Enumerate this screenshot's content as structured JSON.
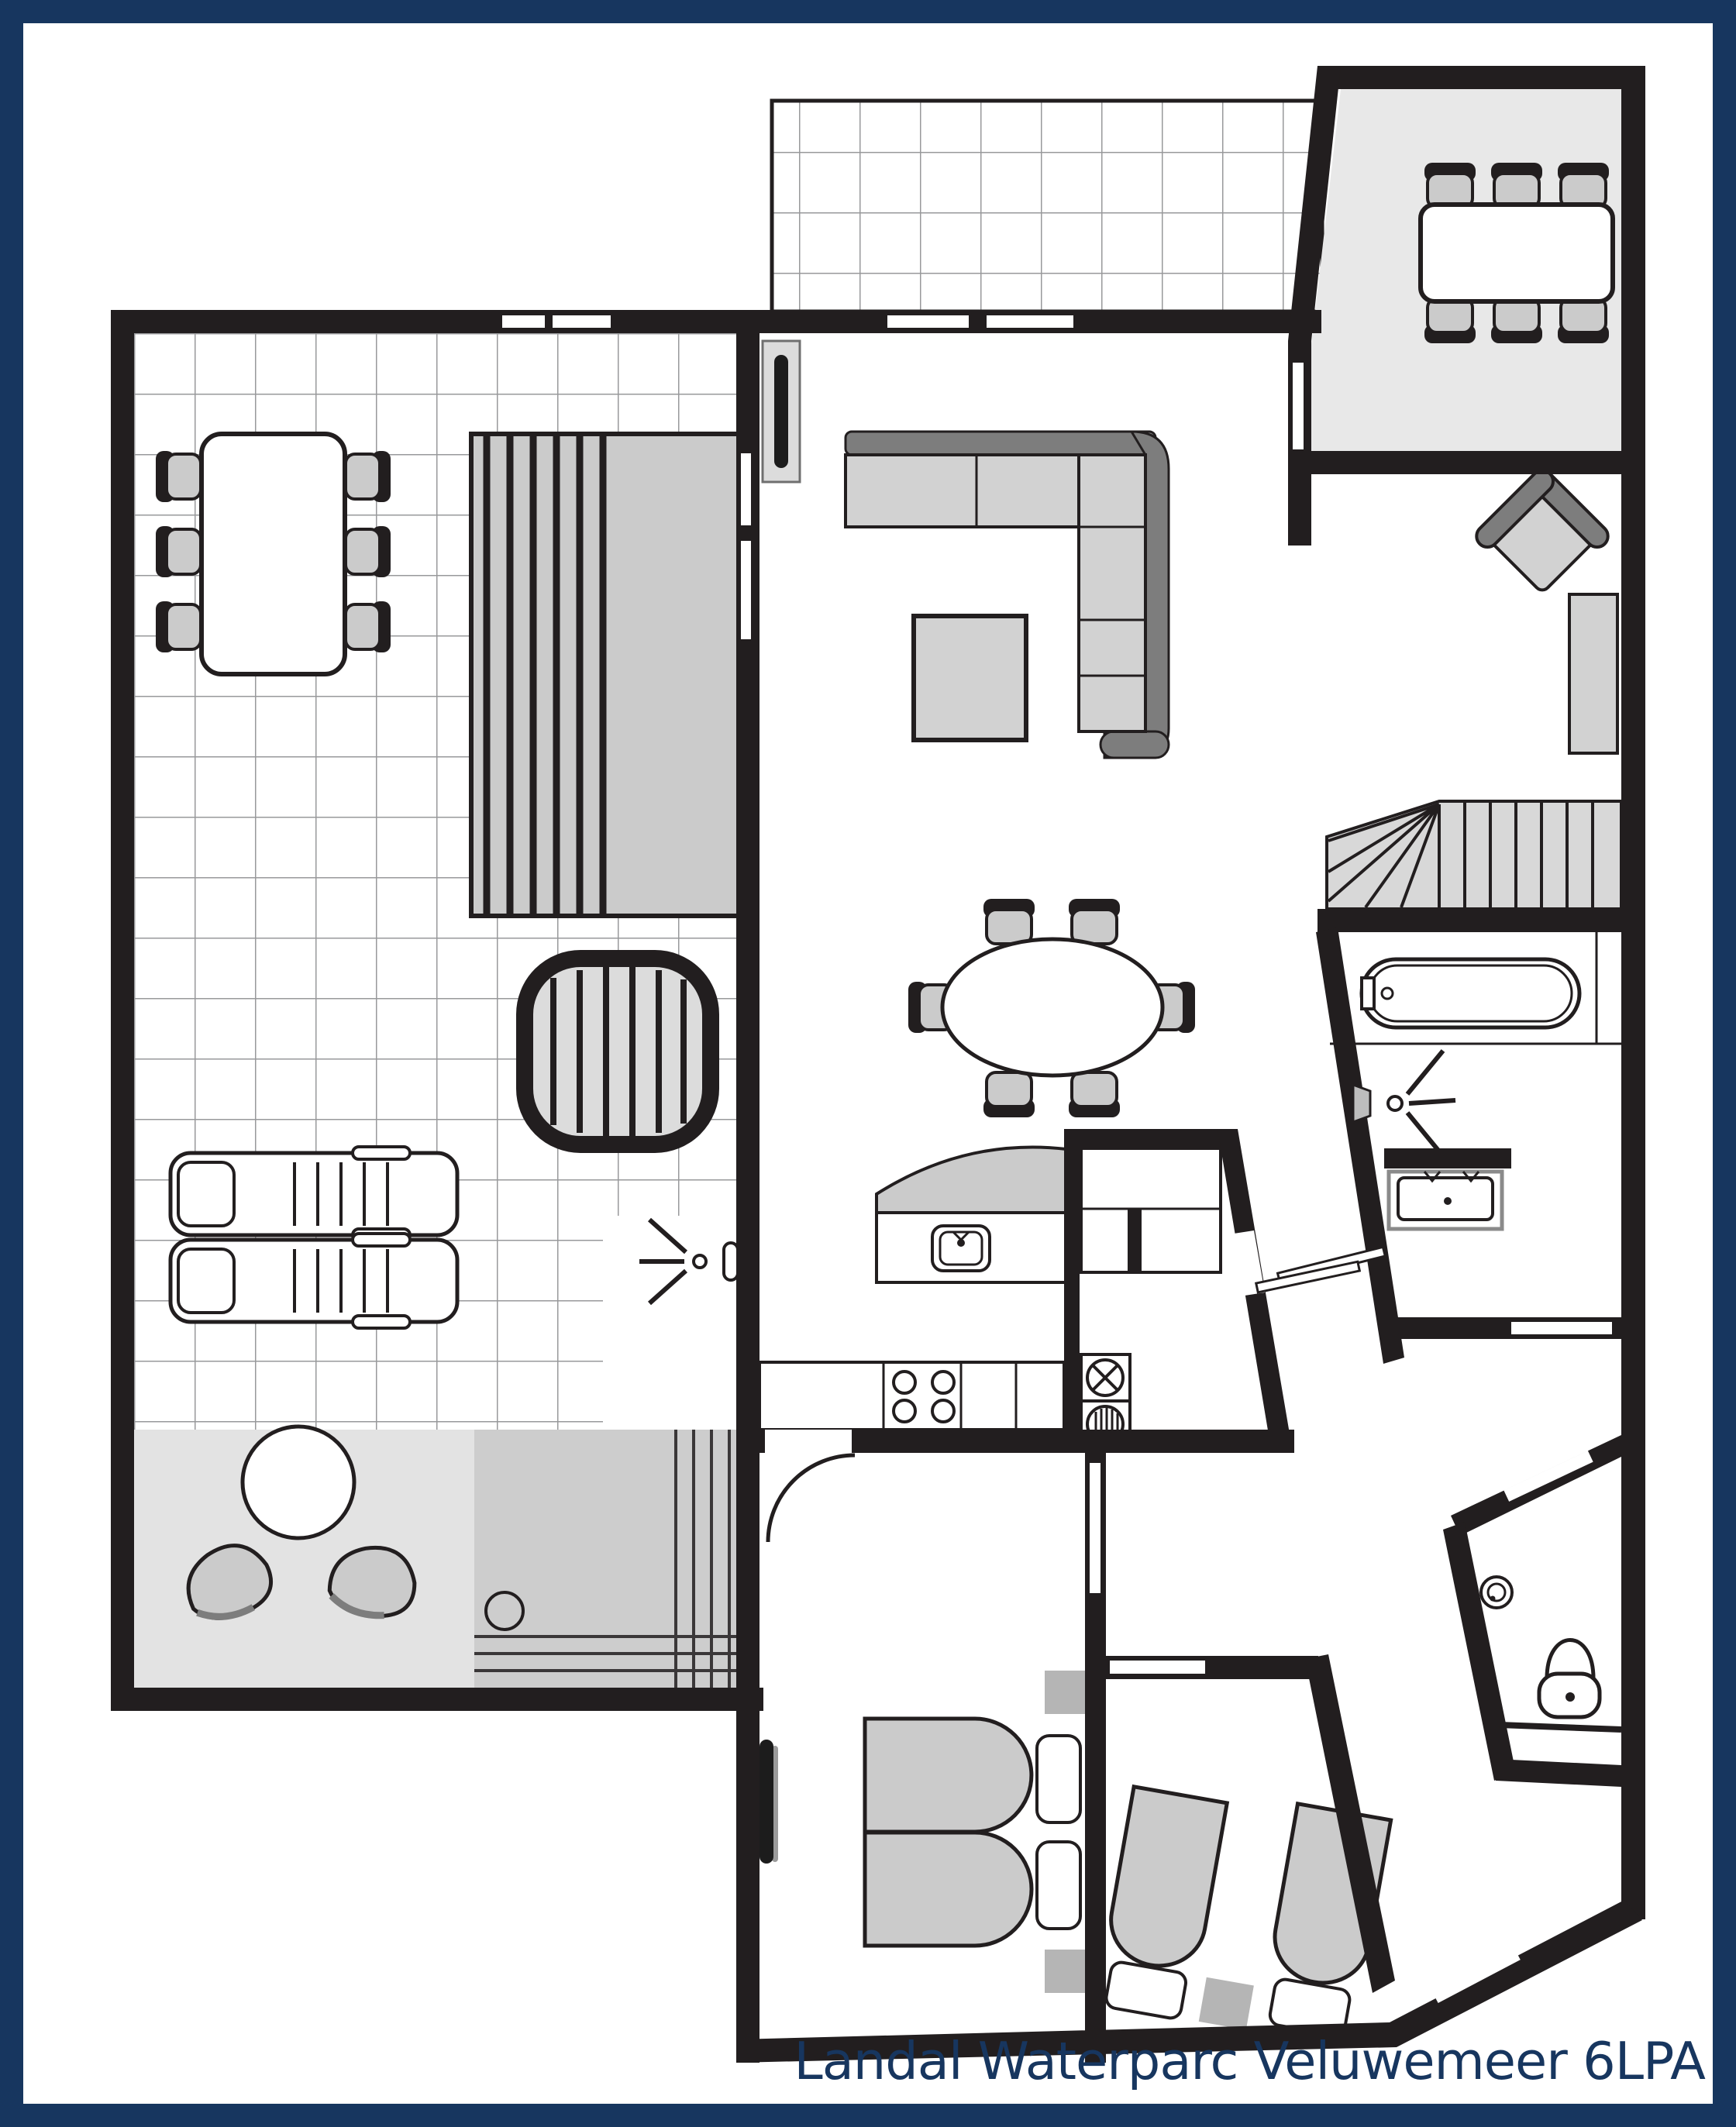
{
  "title": "Landal Waterparc Veluwemeer 6LPA",
  "palette": {
    "frame": "#17365f",
    "ink": "#221e1f",
    "furn": "#cbcbcb",
    "furndark": "#7d7d7d",
    "roomlight": "#e8e8e8",
    "tile": "#98999b",
    "stair": "#d8d8d8",
    "cabin": "#cdcdcd",
    "lounge": "#e3e3e3",
    "bedside": "#b5b5b5",
    "doorframe": "#dcdcdc"
  }
}
